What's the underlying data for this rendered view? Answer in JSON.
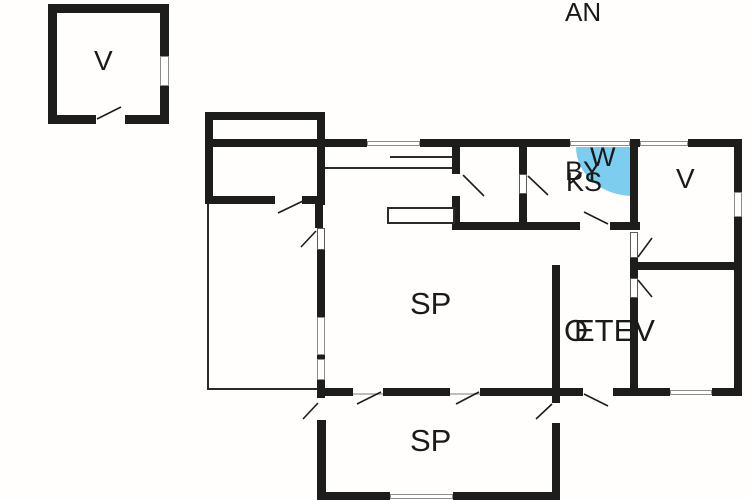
{
  "colors": {
    "background": "#fffefc",
    "wall": "#1d1d1b",
    "blue_highlight": "#7ccdf0",
    "text": "#1a1a18",
    "swing": "#1d1d1b"
  },
  "labels": [
    {
      "text": "V",
      "x": 94,
      "y": 47,
      "fs": 28,
      "name": "room-label-v-outbuilding"
    },
    {
      "text": "AN",
      "x": 565,
      "y": -1,
      "fs": 26,
      "name": "plan-label-an"
    },
    {
      "text": "W",
      "x": 590,
      "y": 144,
      "fs": 27,
      "name": "room-label-w"
    },
    {
      "text": "BY",
      "x": 565,
      "y": 158,
      "fs": 27,
      "name": "room-label-by"
    },
    {
      "text": "KS",
      "x": 566,
      "y": 169,
      "fs": 27,
      "name": "room-label-ks"
    },
    {
      "text": "V",
      "x": 676,
      "y": 165,
      "fs": 28,
      "name": "room-label-v-right"
    },
    {
      "text": "SP",
      "x": 410,
      "y": 288,
      "fs": 31,
      "name": "room-label-sp-main"
    },
    {
      "text": "O",
      "x": 564,
      "y": 315,
      "fs": 31,
      "name": "room-label-o"
    },
    {
      "text": "ETEV",
      "x": 574,
      "y": 315,
      "fs": 31,
      "name": "room-label-etev"
    },
    {
      "text": "SP",
      "x": 410,
      "y": 425,
      "fs": 31,
      "name": "room-label-sp-bottom"
    }
  ],
  "blue_region": {
    "x": 576,
    "y": 147,
    "w": 57,
    "h": 49
  },
  "walls": [
    [
      48,
      4,
      120,
      9
    ],
    [
      48,
      4,
      9,
      120
    ],
    [
      160,
      4,
      9,
      120
    ],
    [
      48,
      115,
      48,
      9
    ],
    [
      125,
      115,
      44,
      9
    ],
    [
      205,
      112,
      120,
      8
    ],
    [
      205,
      112,
      8,
      92
    ],
    [
      317,
      112,
      8,
      93
    ],
    [
      205,
      139,
      162,
      8
    ],
    [
      420,
      139,
      150,
      8
    ],
    [
      630,
      139,
      10,
      8
    ],
    [
      688,
      139,
      54,
      8
    ],
    [
      205,
      196,
      70,
      8
    ],
    [
      302,
      196,
      23,
      8
    ],
    [
      315,
      196,
      8,
      32
    ],
    [
      452,
      146,
      8,
      28
    ],
    [
      452,
      196,
      8,
      34
    ],
    [
      519,
      146,
      8,
      28
    ],
    [
      519,
      194,
      8,
      36
    ],
    [
      452,
      222,
      128,
      8
    ],
    [
      610,
      222,
      30,
      8
    ],
    [
      630,
      146,
      8,
      84
    ],
    [
      630,
      258,
      8,
      20
    ],
    [
      630,
      298,
      8,
      94
    ],
    [
      633,
      262,
      109,
      8
    ],
    [
      552,
      265,
      8,
      127
    ],
    [
      552,
      395,
      8,
      8
    ],
    [
      552,
      423,
      8,
      72
    ],
    [
      317,
      250,
      8,
      67
    ],
    [
      317,
      355,
      8,
      4
    ],
    [
      317,
      380,
      8,
      18
    ],
    [
      317,
      388,
      36,
      8
    ],
    [
      383,
      388,
      67,
      8
    ],
    [
      480,
      388,
      103,
      8
    ],
    [
      613,
      388,
      27,
      8
    ],
    [
      640,
      388,
      30,
      8
    ],
    [
      712,
      388,
      30,
      8
    ],
    [
      734,
      139,
      8,
      53
    ],
    [
      734,
      217,
      8,
      179
    ],
    [
      317,
      420,
      9,
      80
    ],
    [
      317,
      492,
      73,
      8
    ],
    [
      453,
      492,
      107,
      8
    ]
  ],
  "thin_lines": [
    [
      207,
      204,
      2,
      186
    ],
    [
      207,
      388,
      110,
      2
    ],
    [
      390,
      156,
      63,
      2
    ],
    [
      325,
      167,
      128,
      2
    ]
  ],
  "windows": [
    [
      160,
      56,
      9,
      30
    ],
    [
      367,
      141,
      53,
      5
    ],
    [
      570,
      141,
      60,
      5
    ],
    [
      640,
      141,
      48,
      5
    ],
    [
      317,
      317,
      8,
      38
    ],
    [
      317,
      359,
      8,
      21
    ],
    [
      734,
      192,
      8,
      25
    ],
    [
      670,
      390,
      42,
      5
    ],
    [
      390,
      494,
      63,
      5
    ]
  ],
  "door_leaves": [
    [
      519,
      174,
      8,
      20
    ],
    [
      630,
      232,
      8,
      26
    ],
    [
      630,
      278,
      8,
      20
    ],
    [
      317,
      228,
      8,
      22
    ]
  ],
  "thresholds": [
    [
      353,
      393,
      30,
      2
    ],
    [
      450,
      393,
      30,
      2
    ]
  ],
  "counter": {
    "x": 387,
    "y": 207,
    "w": 68,
    "h": 17
  },
  "swings": [
    [
      97,
      119,
      121,
      107
    ],
    [
      303,
      201,
      278,
      213
    ],
    [
      316,
      231,
      301,
      247
    ],
    [
      463,
      175,
      484,
      196
    ],
    [
      528,
      176,
      548,
      195
    ],
    [
      608,
      224,
      584,
      212
    ],
    [
      638,
      257,
      652,
      238
    ],
    [
      638,
      280,
      652,
      297
    ],
    [
      381,
      392,
      357,
      404
    ],
    [
      479,
      392,
      456,
      404
    ],
    [
      584,
      394,
      608,
      406
    ],
    [
      552,
      404,
      536,
      419
    ],
    [
      318,
      403,
      303,
      419
    ]
  ]
}
